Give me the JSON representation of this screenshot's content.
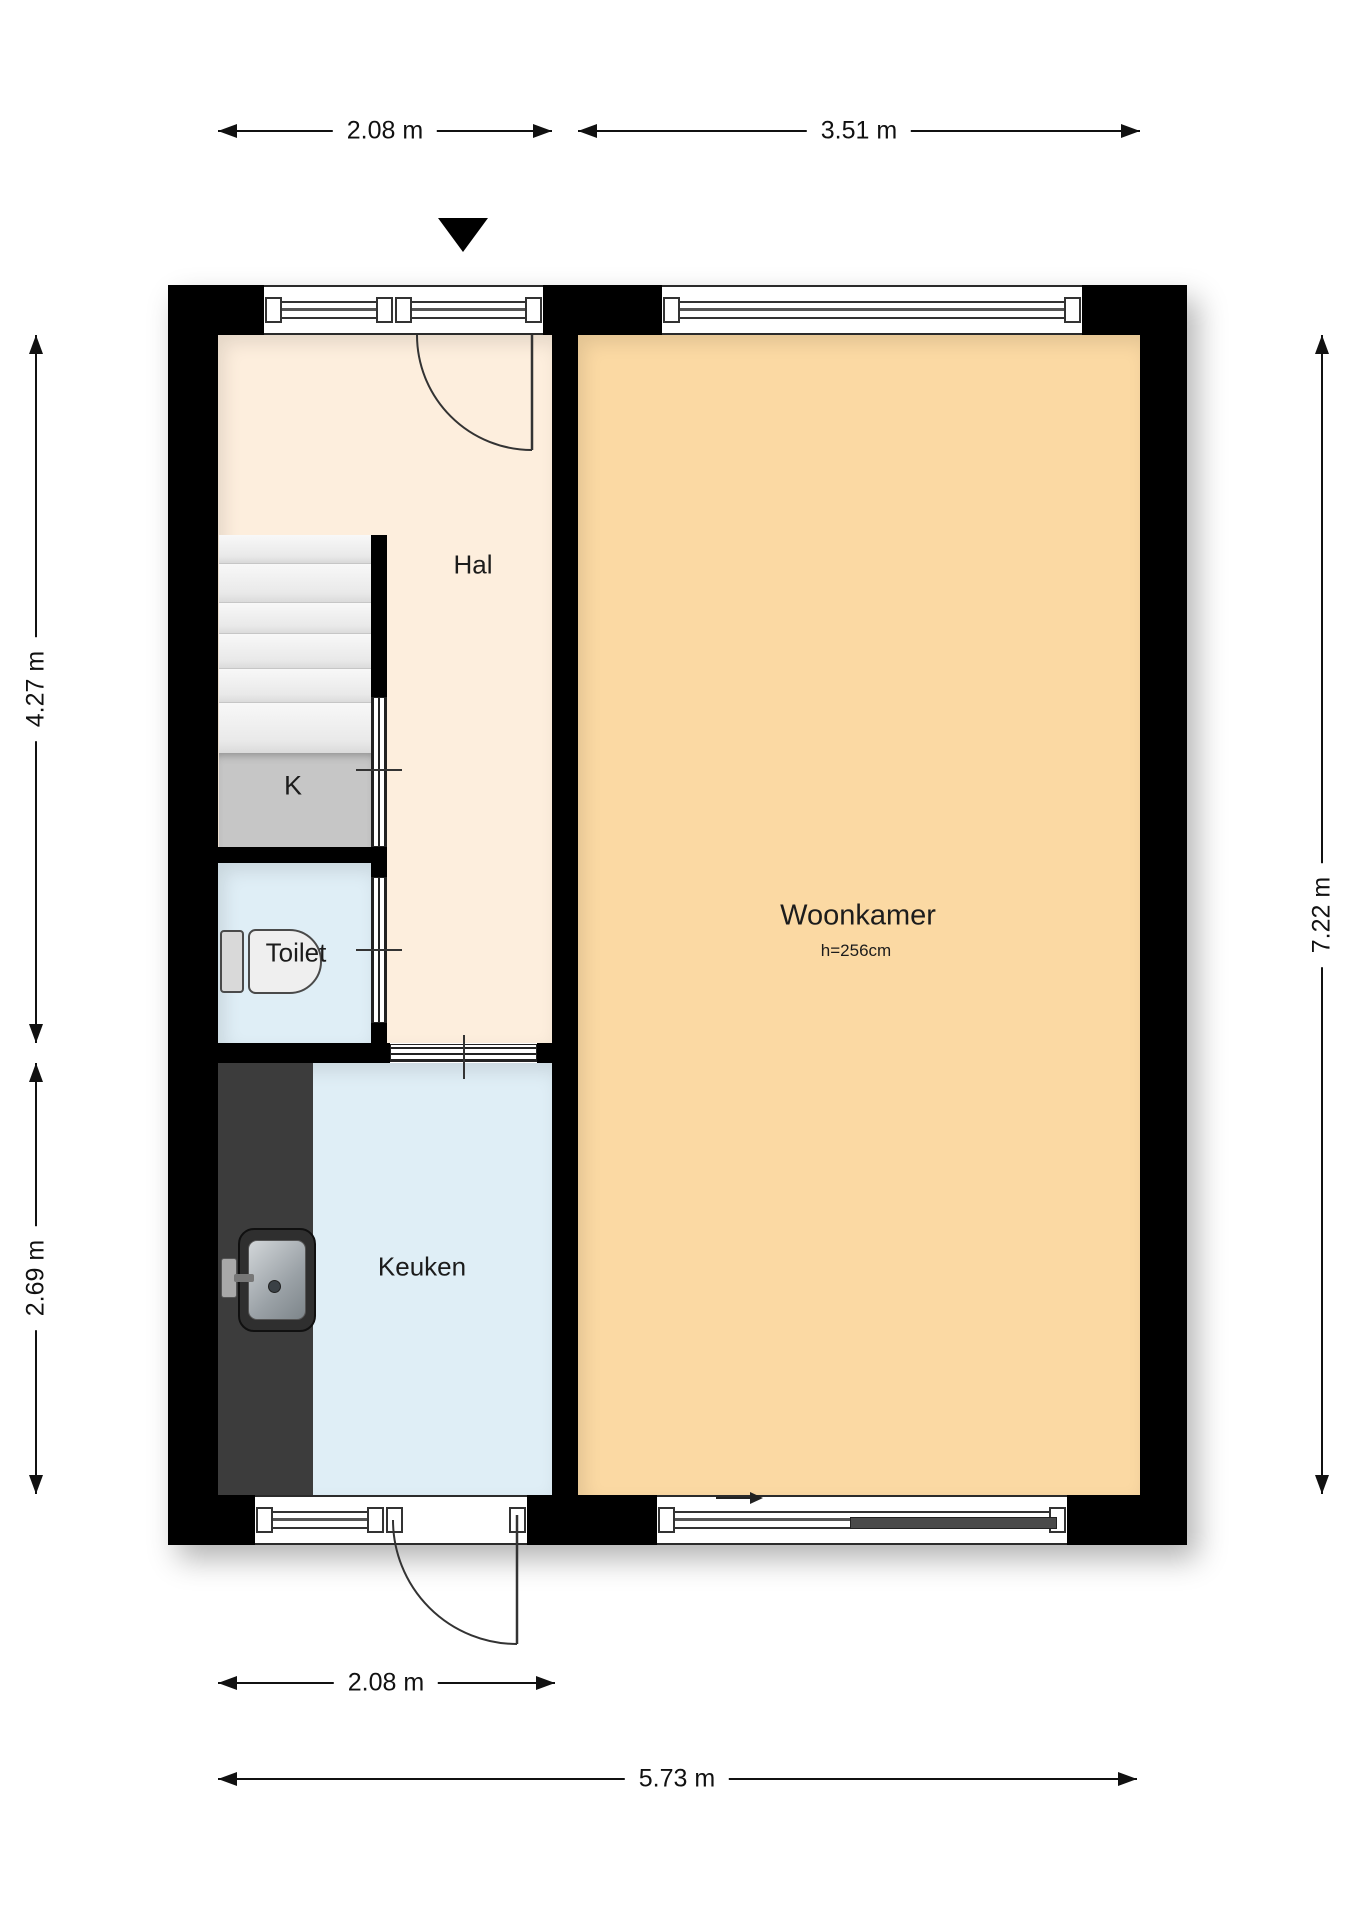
{
  "floorplan": {
    "rooms": {
      "hal": {
        "label": "Hal"
      },
      "closet": {
        "label": "K"
      },
      "toilet": {
        "label": "Toilet"
      },
      "kitchen": {
        "label": "Keuken"
      },
      "living_room": {
        "label": "Woonkamer",
        "ceiling_height": "h=256cm"
      }
    },
    "dimensions": {
      "top_hall_width": "2.08 m",
      "top_living_width": "3.51 m",
      "left_upper_depth": "4.27 m",
      "left_lower_depth": "2.69 m",
      "right_total_depth": "7.22 m",
      "bottom_kitchen_width": "2.08 m",
      "bottom_total_width": "5.73 m"
    },
    "colors": {
      "wall": "#000000",
      "hal_floor": "#fdeedd",
      "living_floor": "#fbd9a3",
      "toilet_floor": "#dfeef6",
      "kitchen_floor": "#dfeef6",
      "stairs": "#ececec",
      "closet_fill": "#c6c6c6",
      "counter": "#3c3c3c",
      "dimension_text": "#111111"
    }
  }
}
